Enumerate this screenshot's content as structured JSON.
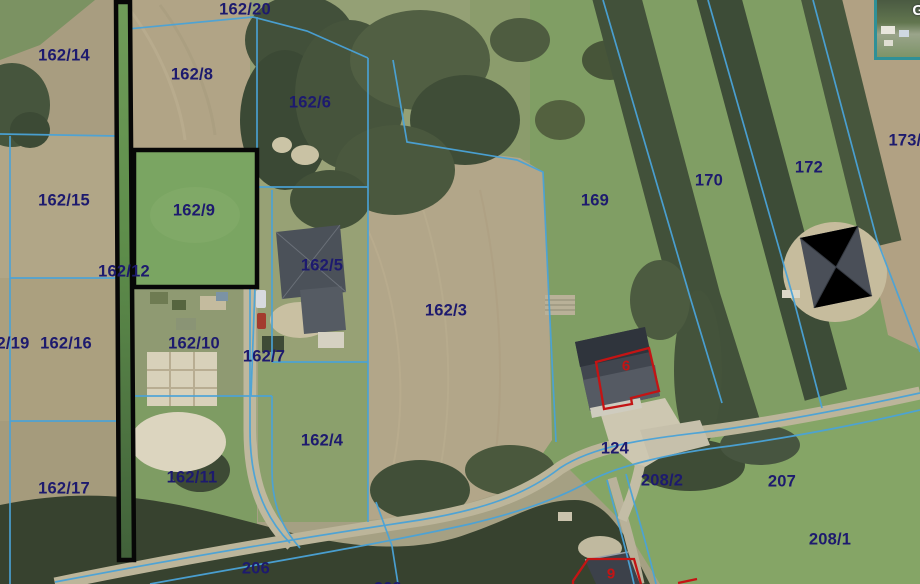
{
  "map": {
    "type": "cadastral-parcel-map-over-aerial-imagery",
    "label_color": "#1d1a6e",
    "boundary_line_color": "#4aa3d8",
    "selected_parcel_outline_color": "#000000",
    "building_marker_color": "#c41414",
    "parcel_labels": [
      {
        "label": "162/14"
      },
      {
        "label": "162/8"
      },
      {
        "label": "162/20"
      },
      {
        "label": "162/6"
      },
      {
        "label": "162/15"
      },
      {
        "label": "162/9"
      },
      {
        "label": "162/12"
      },
      {
        "label": "2/19"
      },
      {
        "label": "162/16"
      },
      {
        "label": "162/10"
      },
      {
        "label": "162/7"
      },
      {
        "label": "162/5"
      },
      {
        "label": "162/3"
      },
      {
        "label": "162/4"
      },
      {
        "label": "169"
      },
      {
        "label": "170"
      },
      {
        "label": "172"
      },
      {
        "label": "173/"
      },
      {
        "label": "162/17"
      },
      {
        "label": "162/11"
      },
      {
        "label": "206"
      },
      {
        "label": "124"
      },
      {
        "label": "208/2"
      },
      {
        "label": "207"
      },
      {
        "label": "208/1"
      },
      {
        "label": "209"
      }
    ],
    "selected_parcels": [
      "162/12",
      "162/9"
    ],
    "building_markers": [
      {
        "label": "6"
      },
      {
        "label": "9"
      }
    ],
    "inset": {
      "glyph": "G"
    }
  }
}
